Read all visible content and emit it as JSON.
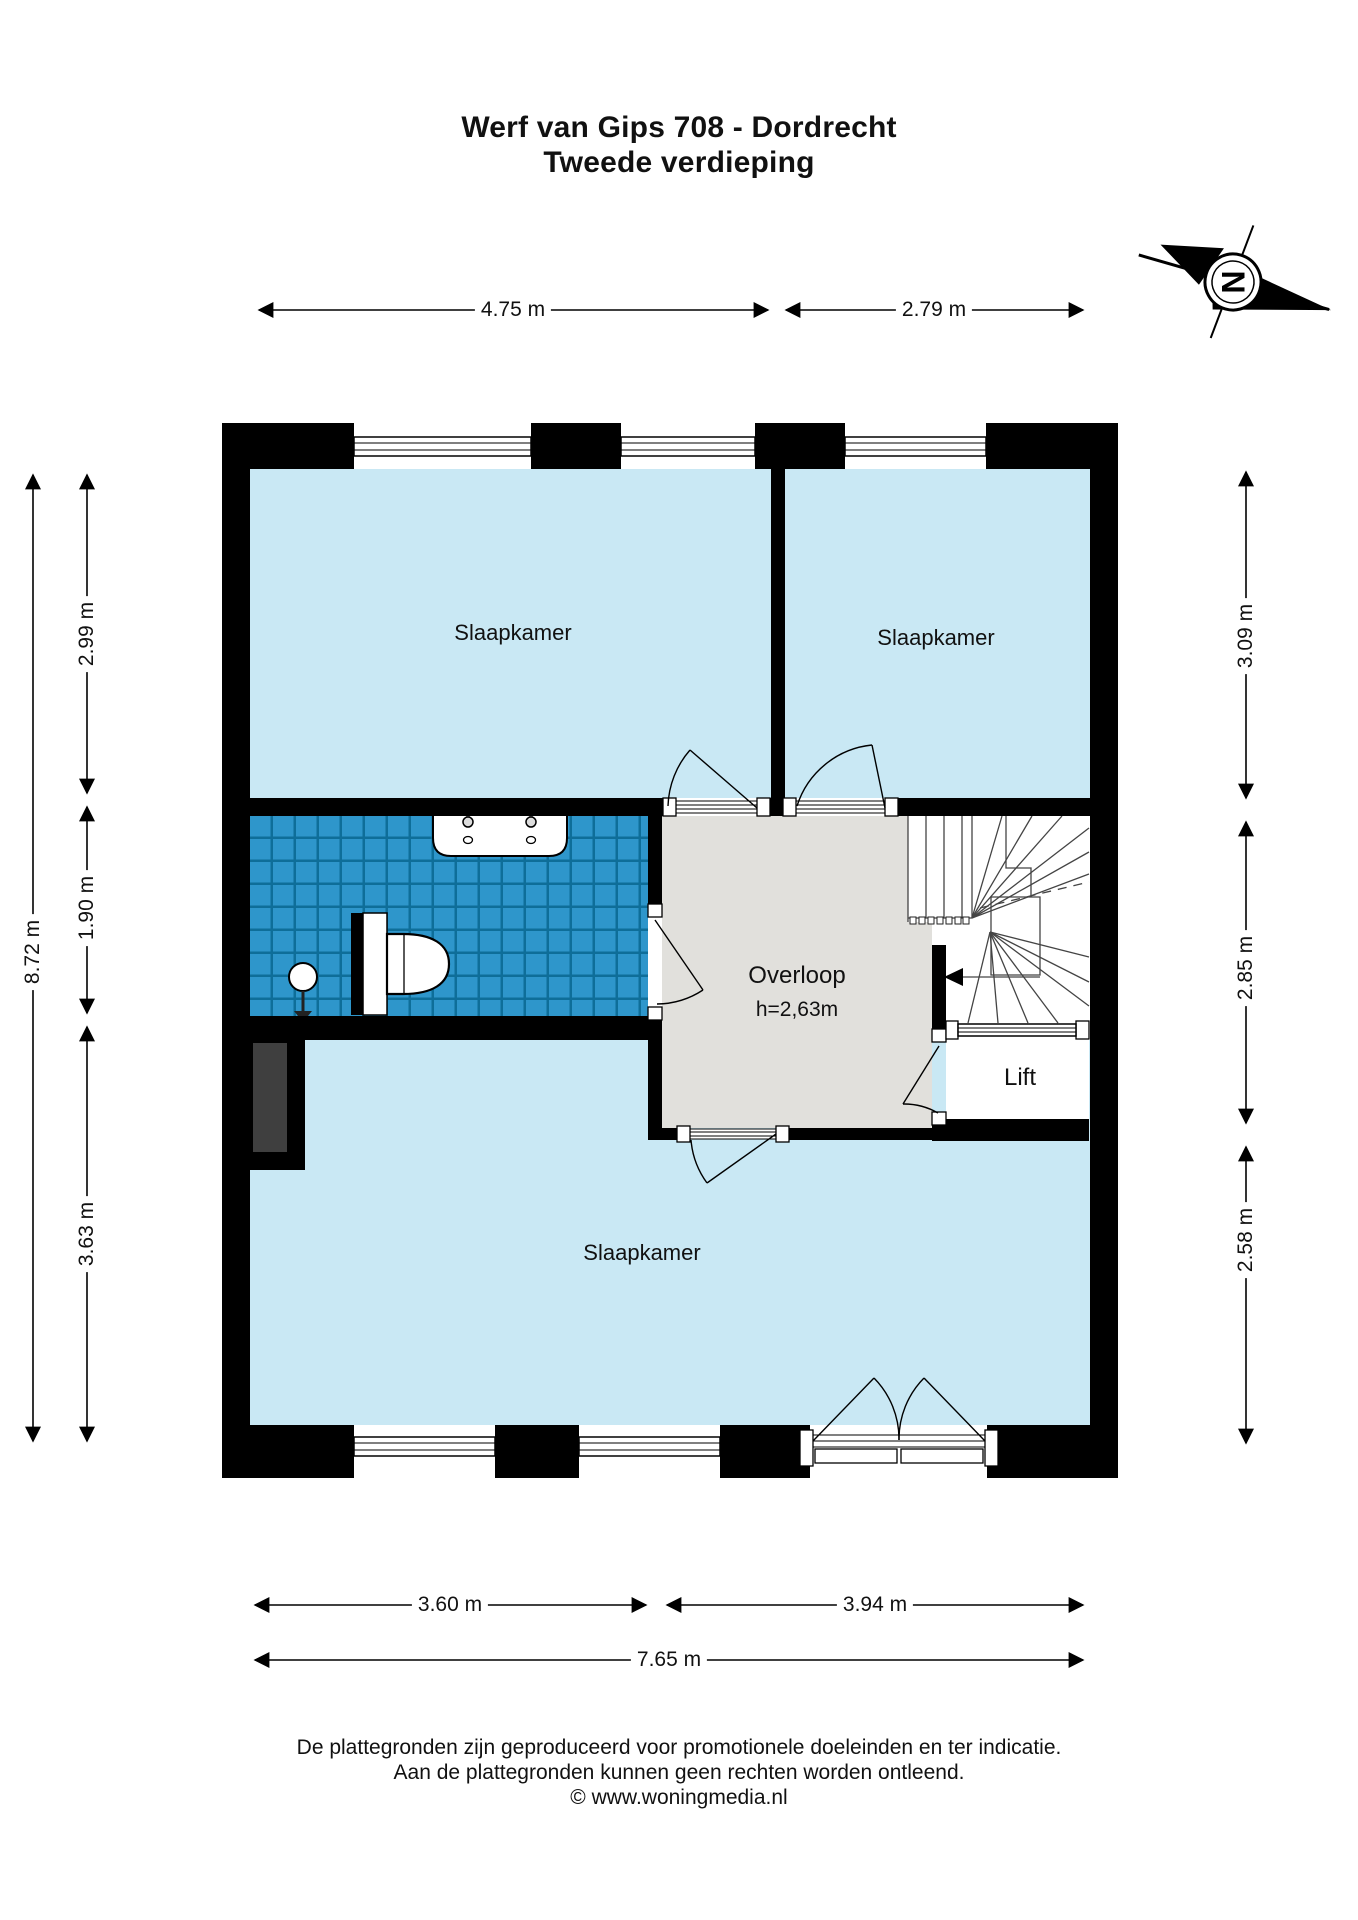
{
  "title": {
    "line1": "Werf van Gips 708 - Dordrecht",
    "line2": "Tweede verdieping"
  },
  "compass": {
    "label": "N"
  },
  "dimensions": {
    "top": [
      "4.75 m",
      "2.79 m"
    ],
    "left_total": "8.72 m",
    "left": [
      "2.99 m",
      "1.90 m",
      "3.63 m"
    ],
    "right": [
      "3.09 m",
      "2.85 m",
      "2.58 m"
    ],
    "bottom": [
      "3.60 m",
      "3.94 m"
    ],
    "bottom_total": "7.65 m"
  },
  "rooms": {
    "bedroom_top_left": "Slaapkamer",
    "bedroom_top_right": "Slaapkamer",
    "bedroom_bottom": "Slaapkamer",
    "landing": "Overloop",
    "landing_height": "h=2,63m",
    "lift": "Lift"
  },
  "footer": {
    "line1": "De plattegronden zijn geproduceerd voor promotionele doeleinden en ter indicatie.",
    "line2": "Aan de plattegronden kunnen geen rechten worden ontleend.",
    "line3": "© www.woningmedia.nl"
  },
  "colors": {
    "wall": "#000000",
    "room_fill": "#c9e8f4",
    "tile_fill": "#2e96cb",
    "tile_grid": "#0e6e99",
    "landing_fill": "#e1e0dc",
    "shaft_fill": "#3f3f3f",
    "stair_line": "#444444"
  }
}
